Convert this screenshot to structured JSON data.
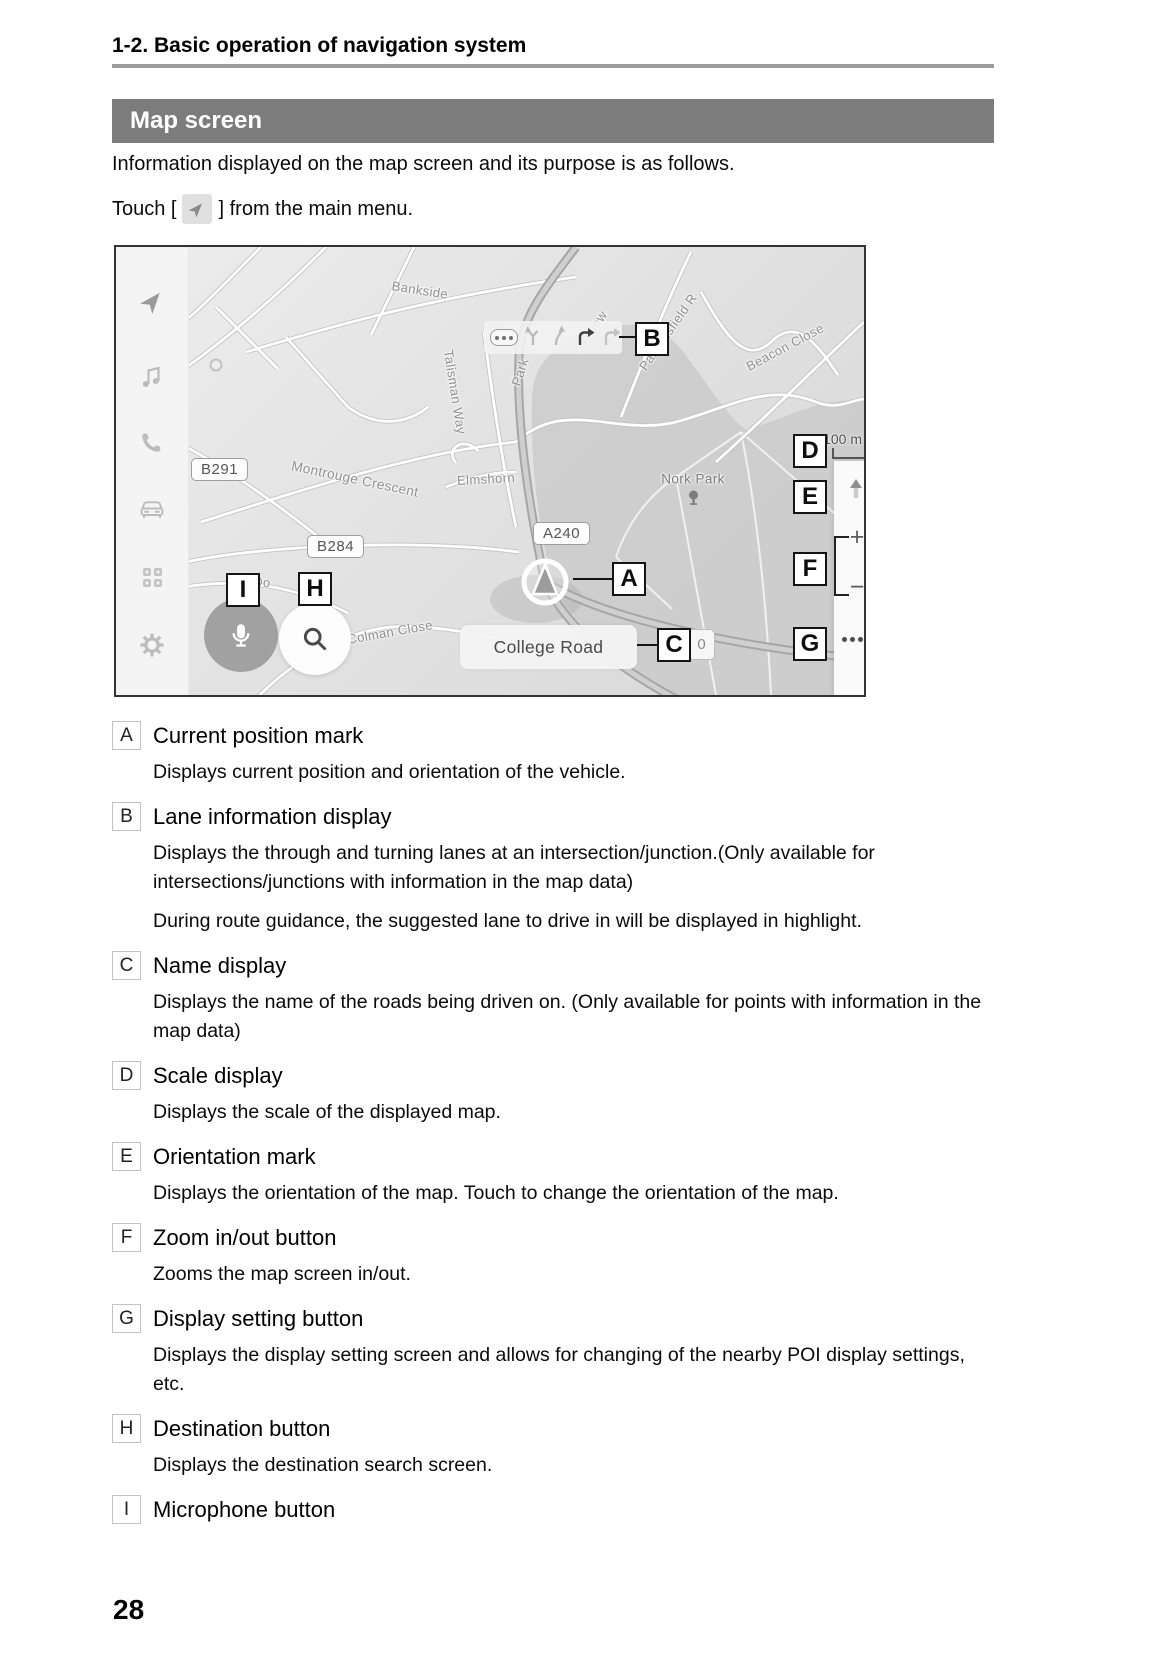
{
  "header": {
    "breadcrumb": "1-2. Basic operation of navigation system",
    "section_banner": "Map screen"
  },
  "intro": {
    "line1": "Information displayed on the map screen and its purpose is as follows.",
    "touch_before": "Touch [",
    "touch_after": "] from the main menu.",
    "touch_icon": "navigation-arrow-icon"
  },
  "map_screen": {
    "scale_label": "100 m",
    "road_name_display": "College Road",
    "poi_counter": "0",
    "zoom_in_label": "+",
    "zoom_out_label": "−",
    "shields": [
      "B291",
      "B284",
      "A240"
    ],
    "streets": [
      "Bankside",
      "Talisman Way",
      "Montrouge Crescent",
      "Elmshorn",
      "Nork Park",
      "Parsonsfield R",
      "Beacon Close",
      "od View",
      "Park",
      "Colman Close",
      "Do"
    ],
    "callout_letters": [
      "A",
      "B",
      "C",
      "D",
      "E",
      "F",
      "G",
      "H",
      "I"
    ],
    "sidebar_icons": [
      "navigation-icon",
      "music-icon",
      "phone-icon",
      "car-icon",
      "apps-grid-icon",
      "settings-gear-icon"
    ],
    "lane_icons": [
      "more-dots-pill",
      "fork-arrow",
      "slight-right-arrow",
      "right-turn-arrow-active",
      "right-turn-arrow"
    ]
  },
  "items": [
    {
      "key": "A",
      "title": "Current position mark",
      "paragraphs": [
        "Displays current position and orientation of the vehicle."
      ]
    },
    {
      "key": "B",
      "title": "Lane information display",
      "paragraphs": [
        "Displays the through and turning lanes at an intersection/junction.(Only available for intersections/junctions with information in the map data)",
        "During route guidance, the suggested lane to drive in will be displayed in highlight."
      ]
    },
    {
      "key": "C",
      "title": "Name display",
      "paragraphs": [
        "Displays the name of the roads being driven on. (Only available for points with information in the map data)"
      ]
    },
    {
      "key": "D",
      "title": "Scale display",
      "paragraphs": [
        "Displays the scale of the displayed map."
      ]
    },
    {
      "key": "E",
      "title": "Orientation mark",
      "paragraphs": [
        "Displays the orientation of the map. Touch to change the orientation of the map."
      ]
    },
    {
      "key": "F",
      "title": "Zoom in/out button",
      "paragraphs": [
        "Zooms the map screen in/out."
      ]
    },
    {
      "key": "G",
      "title": "Display setting button",
      "paragraphs": [
        "Displays the display setting screen and allows for changing of the nearby POI display settings, etc."
      ]
    },
    {
      "key": "H",
      "title": "Destination button",
      "paragraphs": [
        "Displays the destination search screen."
      ]
    },
    {
      "key": "I",
      "title": "Microphone button",
      "paragraphs": []
    }
  ],
  "footer": {
    "page_number": "28"
  },
  "colors": {
    "banner_bg": "#7c7c7c",
    "banner_text": "#ffffff",
    "rule": "#9c9c9c",
    "callout_border": "#141414",
    "park_fill": "#c8c8c8"
  }
}
